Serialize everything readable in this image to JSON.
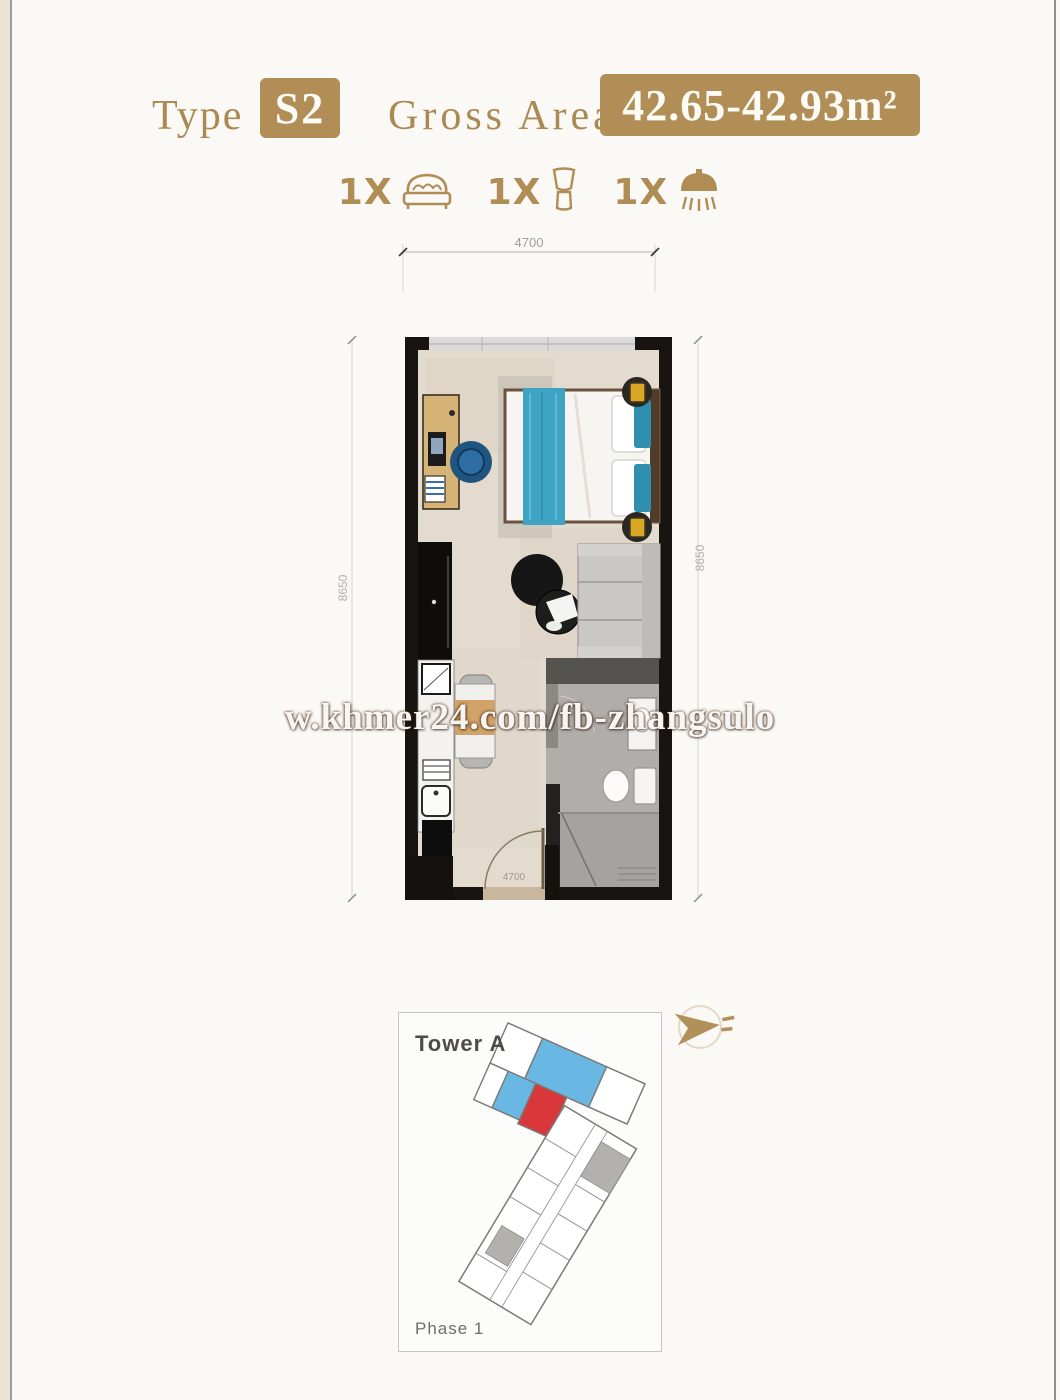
{
  "page": {
    "background": "#fbf9f5",
    "edge_strip_color": "#ece4d2"
  },
  "header": {
    "type_label": "Type",
    "type_value": "S2",
    "area_label": "Gross Area",
    "area_value": "42.65-42.93m²",
    "badge_color": "#b08e55",
    "text_color": "#ab8952"
  },
  "features": {
    "bed": {
      "count": "1X",
      "icon": "bed-icon"
    },
    "toilet": {
      "count": "1X",
      "icon": "toilet-icon"
    },
    "shower": {
      "count": "1X",
      "icon": "shower-icon"
    }
  },
  "floor_plan": {
    "dim_top": "4700",
    "dim_left": "8650",
    "dim_right": "8650",
    "door_dim": "4700",
    "wall_color": "#181411",
    "floor_color": "#e3dbce",
    "bed_blanket_color": "#3fa3c4",
    "bathroom_floor_color": "#b0adaa",
    "rooms": [
      "bedroom",
      "living-dining",
      "kitchenette",
      "bathroom"
    ]
  },
  "watermark": {
    "text": "w.khmer24.com/fb-zhangsulo"
  },
  "mini_map": {
    "tower_label": "Tower A",
    "phase_label": "Phase 1",
    "highlight_red": "#d9383b",
    "highlight_blue": "#69b8e3",
    "outline_color": "#7b7977"
  },
  "compass": {
    "icon": "north-arrow-icon",
    "color": "#b2905a"
  }
}
